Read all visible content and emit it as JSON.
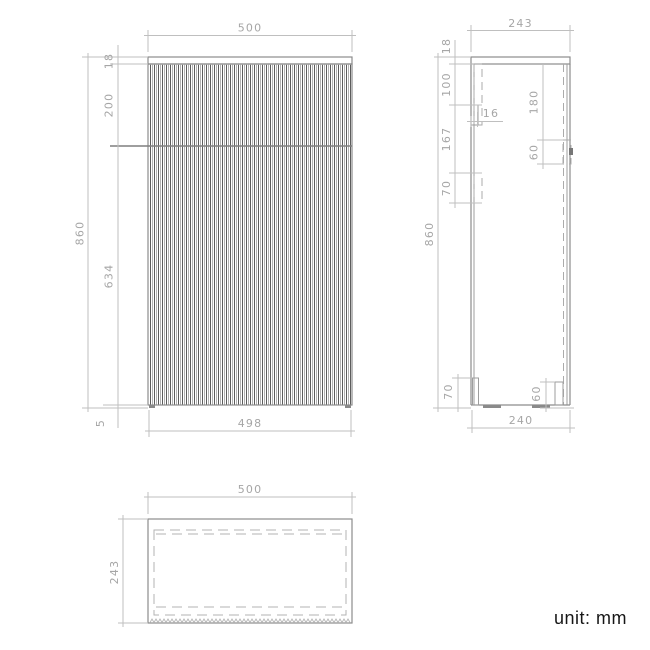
{
  "drawing": {
    "unit_note": "unit: mm",
    "front_view": {
      "overall_width": "500",
      "top_panel_height": "18",
      "drawer_front_height": "200",
      "overall_height": "860",
      "door_front_height": "634",
      "plinth_height": "5",
      "bottom_width": "498"
    },
    "side_view": {
      "overall_depth": "243",
      "top_panel_height": "18",
      "hanger_offset": "100",
      "hanger_rail_depth": "16",
      "hanger_gap": "167",
      "upper_back_bracket_height": "70",
      "front_bracket_offset": "180",
      "front_bracket_height": "60",
      "overall_height": "860",
      "back_foot_height": "70",
      "front_foot_height": "60",
      "bottom_depth": "240"
    },
    "top_view": {
      "overall_width": "500",
      "overall_depth": "243"
    }
  }
}
